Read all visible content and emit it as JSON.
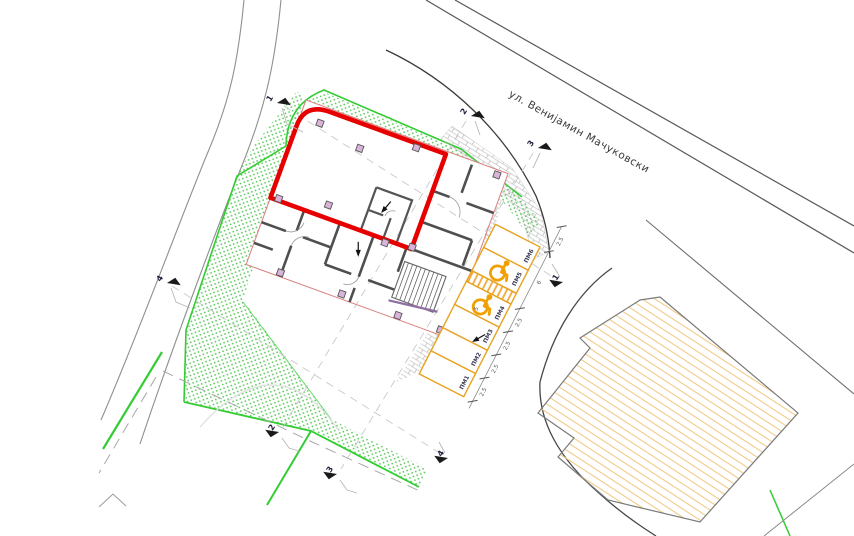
{
  "street": {
    "name": "ул. Венијамин Мачуковски"
  },
  "axes": {
    "a1": "1",
    "a2": "2",
    "a3": "3",
    "a4": "4"
  },
  "parking": {
    "labels": [
      "ПМ1",
      "ПМ2",
      "ПМ3",
      "ПМ4",
      "ПМ5",
      "ПМ6"
    ],
    "dims": {
      "stall_width": "2.5",
      "group_width": "6",
      "stall_depth": "5",
      "sidewalk": "2.5"
    }
  },
  "colors": {
    "selected_unit": "#e60000",
    "building_outline": "#d98080",
    "wall": "#4f4f4f",
    "parking_line": "#e8a21f",
    "accessible_icon": "#f0a000",
    "boundary_green": "#33cc33",
    "hatch_green": "#58c858",
    "road_gray": "#8f8f8f",
    "street_gray": "#585858",
    "adjacent_hatch": "#efcb86",
    "column_fill": "#d9b3d9"
  }
}
